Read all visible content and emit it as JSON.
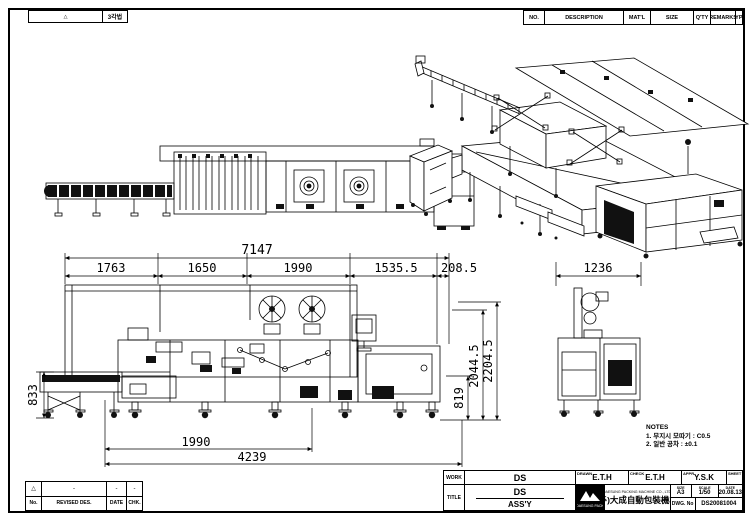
{
  "colors": {
    "ink": "#000000",
    "paper": "#ffffff"
  },
  "projection_strip": {
    "mark": "△",
    "label": "3각법"
  },
  "bom_header": {
    "columns": [
      "NO.",
      "DESCRIPTION",
      "MAT'L",
      "SIZE",
      "Q'TY",
      "REMARKS",
      "TYPE"
    ]
  },
  "drawing": {
    "dimensions": {
      "overall": "7147",
      "segments": [
        "1763",
        "1650",
        "1990",
        "1535.5",
        "208.5"
      ],
      "side_view_width": "1236",
      "infeed_height": "833",
      "right_heights": [
        "819",
        "2044.5",
        "2204.5"
      ],
      "bottom": [
        "1990",
        "4239"
      ]
    }
  },
  "notes": {
    "title": "NOTES",
    "items": [
      "1. 무지시 모따기 : C0.5",
      "2. 일반 공차 : ±0.1"
    ]
  },
  "revision_table": {
    "row": {
      "mark": "△",
      "c1": "-",
      "c2": "-",
      "c3": "-"
    },
    "headers": {
      "no": "No.",
      "desc": "REVISED DES.",
      "date": "DATE",
      "chk": "CHK."
    }
  },
  "title_block": {
    "work": {
      "label": "WORK",
      "value": "DS"
    },
    "title": {
      "label": "TITLE",
      "value": "DS",
      "sub": "ASS'Y"
    },
    "signs": [
      {
        "label": "DRAWN",
        "value": "E.T.H"
      },
      {
        "label": "CHECK",
        "value": "E.T.H"
      },
      {
        "label": "APPR.",
        "value": "Y.S.K"
      },
      {
        "label": "SHEET",
        "value": ""
      }
    ],
    "company": {
      "en": "DAESUNG PACKING MACHINE CO., LTD.",
      "ko": "(주)大成自動包裝機械",
      "logo_caption": "DAESUNG PACK"
    },
    "meta": {
      "size_label": "SIZE",
      "size": "A3",
      "scale_label": "SCALE",
      "scale": "1/50",
      "date_label": "DATE",
      "date": "20.08.13",
      "dwg_label": "DWG. No",
      "dwg_no": "DS20081004"
    }
  }
}
